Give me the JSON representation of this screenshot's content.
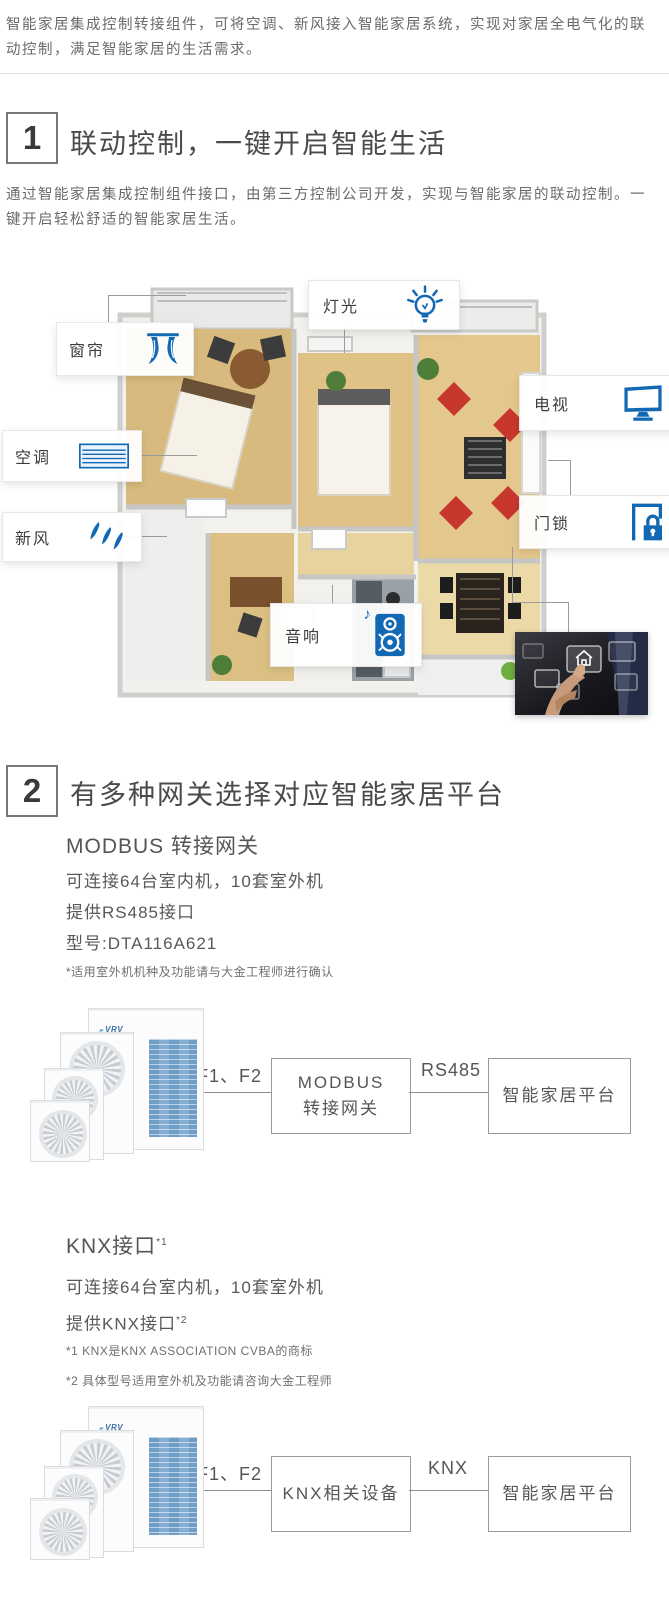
{
  "intro": {
    "text": "智能家居集成控制转接组件，可将空调、新风接入智能家居系统，实现对家居全电气化的联动控制，满足智能家居的生活需求。"
  },
  "section1": {
    "number": "1",
    "title": "联动控制，一键开启智能生活",
    "description": "通过智能家居集成控制组件接口，由第三方控制公司开发，实现与智能家居的联动控制。一键开启轻松舒适的智能家居生活。",
    "labels": [
      {
        "id": "curtain",
        "text": "窗帘"
      },
      {
        "id": "light",
        "text": "灯光"
      },
      {
        "id": "tv",
        "text": "电视"
      },
      {
        "id": "ac",
        "text": "空调"
      },
      {
        "id": "fresh-air",
        "text": "新风"
      },
      {
        "id": "door-lock",
        "text": "门锁"
      },
      {
        "id": "speaker",
        "text": "音响"
      }
    ],
    "music_note": "♪"
  },
  "section2": {
    "number": "2",
    "title": "有多种网关选择对应智能家居平台",
    "modbus": {
      "subtitle": "MODBUS 转接网关",
      "specs": [
        "可连接64台室内机，10套室外机",
        "提供RS485接口",
        "型号:DTA116A621"
      ],
      "footnote": "*适用室外机机种及功能请与大金工程师进行确认",
      "diagram": {
        "wire1": "F1、F2",
        "node1_line1": "MODBUS",
        "node1_line2": "转接网关",
        "wire2": "RS485",
        "node2": "智能家居平台"
      }
    },
    "knx": {
      "subtitle": "KNX接口",
      "subtitle_sup": "*1",
      "spec1": "可连接64台室内机，10套室外机",
      "spec2": "提供KNX接口",
      "spec2_sup": "*2",
      "footnote1": "*1 KNX是KNX ASSOCIATION CVBA的商标",
      "footnote2": "*2 具体型号适用室外机及功能请咨询大金工程师",
      "diagram": {
        "wire1": "F1、F2",
        "node1": "KNX相关设备",
        "wire2": "KNX",
        "node2": "智能家居平台"
      }
    }
  },
  "product_logo": "VRV",
  "colors": {
    "accent_blue": "#1268b3",
    "text_dark": "#4a4a4a",
    "text_gray": "#6a6a6a"
  }
}
